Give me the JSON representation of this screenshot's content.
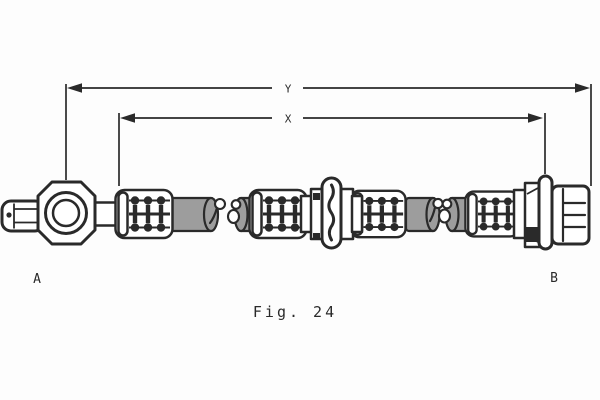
{
  "figure": {
    "caption": "Fig. 24"
  },
  "dimension_lines": {
    "overall_length_label": "Y",
    "hose_length_label": "X"
  },
  "endpoints": {
    "left_label": "A",
    "right_label": "B"
  },
  "colors": {
    "ink": "#2a2a2a",
    "hose_gray": "#9d9d9d",
    "background": "#fdfdfd"
  }
}
